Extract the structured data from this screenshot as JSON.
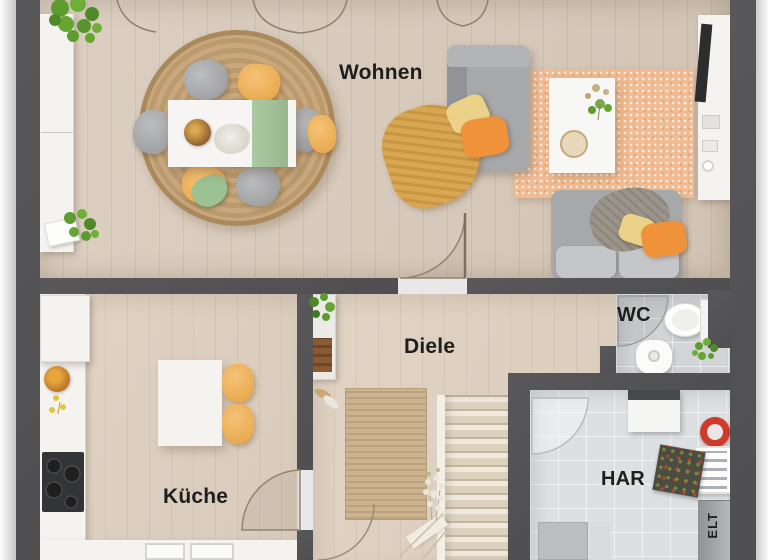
{
  "floor_plan": {
    "type": "floor-plan-render",
    "labels": {
      "living": "Wohnen",
      "kitchen": "Küche",
      "hallway": "Diele",
      "wc": "WC",
      "utility": "HAR",
      "electrical": "ELT"
    },
    "colors": {
      "wall": "#58585a",
      "wood_floor_living": "#d6c9bb",
      "wood_floor_kitchen": "#ddcfc0",
      "tile_floor_wc": "#d2d4d7",
      "tile_floor_utility": "#dde0e2",
      "rug_round_jute": "#c7a67c",
      "rug_hall_jute": "#cdb491",
      "rug_living_orange": "#f0bb92",
      "sofa_gray": "#a7a8aa",
      "pillow_orange": "#f0923a",
      "pillow_yellow": "#ecd289",
      "chair_yellow": "#eeb259",
      "throw_mustard": "#d9a651",
      "table_white": "#f6f5f3",
      "stairs": "#eae2d4",
      "counter_white": "#f0efec",
      "cooktop_black": "#333436",
      "plant_green": "#5e9c2f",
      "accent_red": "#cf3a2c"
    },
    "furniture": [
      "sideboard",
      "round-jute-rug",
      "dining-table",
      "table-runner",
      "dining-chairs",
      "sofa-chaise",
      "sofa",
      "throw-blanket",
      "pillows",
      "orange-rug",
      "coffee-table",
      "tv-lowboard",
      "kitchen-counter",
      "fridge",
      "cooktop",
      "kitchen-sink",
      "kitchen-table",
      "kitchen-chairs",
      "hall-shelf",
      "shoes",
      "hall-rug",
      "staircase",
      "toilet",
      "wash-basin",
      "radiator",
      "washing-machine",
      "hose-reel",
      "tool-shelf",
      "doormat",
      "electrical-panel",
      "plants"
    ]
  }
}
